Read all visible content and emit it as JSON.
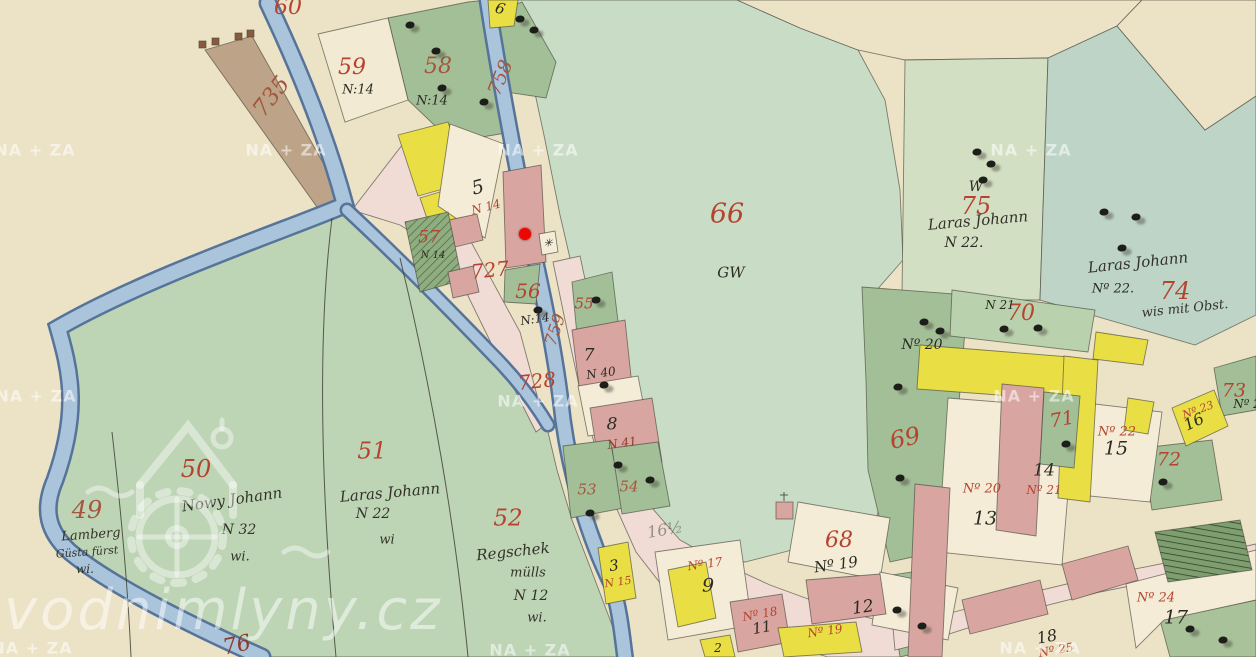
{
  "map": {
    "description": "Historical hand-drawn cadastral map sheet (watercolour parcels, stream, village) shown in vodnimlyny.cz map viewer",
    "marker": {
      "x": 525,
      "y": 234,
      "color": "#ee0600",
      "name": "mill-marker"
    },
    "watermarks": {
      "archive": {
        "text": "NA + ZA",
        "color": "#ffffff",
        "positions": [
          [
            35,
            150
          ],
          [
            286,
            150
          ],
          [
            538,
            150
          ],
          [
            1031,
            150
          ],
          [
            36,
            396
          ],
          [
            538,
            401
          ],
          [
            1034,
            396
          ],
          [
            32,
            648
          ],
          [
            530,
            650
          ],
          [
            1040,
            648
          ]
        ]
      },
      "site": {
        "text": "vodnimlyny.cz",
        "color": "#ffffff"
      }
    },
    "labels": [
      {
        "t": "60",
        "x": 288,
        "y": 8,
        "s": 22,
        "c": "red"
      },
      {
        "t": "735",
        "x": 272,
        "y": 97,
        "s": 23,
        "r": -52,
        "c": "brownred"
      },
      {
        "t": "59",
        "x": 352,
        "y": 68,
        "s": 22,
        "c": "red"
      },
      {
        "t": "58",
        "x": 438,
        "y": 67,
        "s": 22,
        "c": "brownred"
      },
      {
        "t": "758",
        "x": 501,
        "y": 78,
        "s": 19,
        "r": -68,
        "c": "brownred"
      },
      {
        "t": "66",
        "x": 727,
        "y": 214,
        "s": 27,
        "c": "red"
      },
      {
        "t": "75",
        "x": 976,
        "y": 206,
        "s": 24,
        "c": "red"
      },
      {
        "t": "74",
        "x": 1175,
        "y": 291,
        "s": 24,
        "c": "red"
      },
      {
        "t": "727",
        "x": 490,
        "y": 270,
        "s": 20,
        "r": -6,
        "c": "red"
      },
      {
        "t": "56",
        "x": 528,
        "y": 291,
        "s": 20,
        "c": "red"
      },
      {
        "t": "57",
        "x": 429,
        "y": 238,
        "s": 17,
        "c": "red"
      },
      {
        "t": "55",
        "x": 584,
        "y": 304,
        "s": 15,
        "c": "red"
      },
      {
        "t": "759",
        "x": 556,
        "y": 330,
        "s": 17,
        "r": -72,
        "c": "brownred"
      },
      {
        "t": "728",
        "x": 537,
        "y": 381,
        "s": 20,
        "r": -6,
        "c": "red"
      },
      {
        "t": "49",
        "x": 87,
        "y": 510,
        "s": 24,
        "c": "brownred"
      },
      {
        "t": "50",
        "x": 196,
        "y": 469,
        "s": 24,
        "c": "red"
      },
      {
        "t": "51",
        "x": 372,
        "y": 452,
        "s": 23,
        "c": "red"
      },
      {
        "t": "52",
        "x": 508,
        "y": 519,
        "s": 23,
        "c": "red"
      },
      {
        "t": "53",
        "x": 587,
        "y": 490,
        "s": 15,
        "c": "brownred"
      },
      {
        "t": "54",
        "x": 629,
        "y": 487,
        "s": 15,
        "c": "brownred"
      },
      {
        "t": "68",
        "x": 839,
        "y": 541,
        "s": 22,
        "c": "red"
      },
      {
        "t": "69",
        "x": 905,
        "y": 438,
        "s": 24,
        "r": -12,
        "c": "red"
      },
      {
        "t": "70",
        "x": 1021,
        "y": 314,
        "s": 22,
        "c": "red"
      },
      {
        "t": "71",
        "x": 1062,
        "y": 420,
        "s": 19,
        "r": -10,
        "c": "red"
      },
      {
        "t": "72",
        "x": 1169,
        "y": 460,
        "s": 19,
        "c": "red"
      },
      {
        "t": "73",
        "x": 1234,
        "y": 391,
        "s": 19,
        "c": "red"
      },
      {
        "t": "76",
        "x": 237,
        "y": 646,
        "s": 22,
        "r": -12,
        "c": "darkred"
      },
      {
        "t": "N 14",
        "x": 486,
        "y": 207,
        "s": 12,
        "r": -14,
        "c": "red"
      },
      {
        "t": "Nº 17",
        "x": 705,
        "y": 564,
        "s": 12,
        "r": -8,
        "c": "red"
      },
      {
        "t": "N 15",
        "x": 618,
        "y": 582,
        "s": 11,
        "r": -8,
        "c": "red"
      },
      {
        "t": "Nº 18",
        "x": 760,
        "y": 614,
        "s": 12,
        "r": -10,
        "c": "red"
      },
      {
        "t": "Nº 19",
        "x": 825,
        "y": 631,
        "s": 12,
        "r": -8,
        "c": "red"
      },
      {
        "t": "Nº 20",
        "x": 982,
        "y": 489,
        "s": 13,
        "c": "red"
      },
      {
        "t": "Nº 21",
        "x": 1044,
        "y": 490,
        "s": 12,
        "c": "red"
      },
      {
        "t": "Nº 22",
        "x": 1117,
        "y": 432,
        "s": 13,
        "c": "red"
      },
      {
        "t": "Nº 23",
        "x": 1198,
        "y": 410,
        "s": 11,
        "r": -20,
        "c": "red"
      },
      {
        "t": "Nº 24",
        "x": 1156,
        "y": 598,
        "s": 13,
        "c": "red"
      },
      {
        "t": "Nº 25",
        "x": 1056,
        "y": 650,
        "s": 12,
        "r": -10,
        "c": "red"
      },
      {
        "t": "N 41",
        "x": 622,
        "y": 443,
        "s": 12,
        "r": -8,
        "c": "darkred"
      },
      {
        "t": "6",
        "x": 500,
        "y": 9,
        "s": 15,
        "r": 15,
        "c": "black"
      },
      {
        "t": "N:14",
        "x": 358,
        "y": 90,
        "s": 13,
        "c": "black"
      },
      {
        "t": "N:14",
        "x": 432,
        "y": 101,
        "s": 13,
        "c": "black"
      },
      {
        "t": "5",
        "x": 478,
        "y": 188,
        "s": 19,
        "r": -14,
        "c": "black"
      },
      {
        "t": "N:14",
        "x": 535,
        "y": 319,
        "s": 12,
        "r": -8,
        "c": "black"
      },
      {
        "t": "N 14",
        "x": 433,
        "y": 256,
        "s": 10,
        "c": "black"
      },
      {
        "t": "GW",
        "x": 731,
        "y": 273,
        "s": 15,
        "c": "black"
      },
      {
        "t": "W",
        "x": 976,
        "y": 187,
        "s": 14,
        "c": "black"
      },
      {
        "t": "N 22.",
        "x": 964,
        "y": 243,
        "s": 14,
        "c": "black"
      },
      {
        "t": "Nº 22.",
        "x": 1113,
        "y": 289,
        "s": 13,
        "c": "black"
      },
      {
        "t": "Nº 20",
        "x": 922,
        "y": 345,
        "s": 14,
        "c": "black"
      },
      {
        "t": "N 21",
        "x": 1000,
        "y": 305,
        "s": 12,
        "c": "black"
      },
      {
        "t": "N 40",
        "x": 601,
        "y": 373,
        "s": 12,
        "r": -8,
        "c": "black"
      },
      {
        "t": "7",
        "x": 589,
        "y": 356,
        "s": 17,
        "c": "black"
      },
      {
        "t": "8",
        "x": 612,
        "y": 425,
        "s": 17,
        "c": "black"
      },
      {
        "t": "3",
        "x": 614,
        "y": 566,
        "s": 15,
        "r": -8,
        "c": "black"
      },
      {
        "t": "9",
        "x": 708,
        "y": 586,
        "s": 19,
        "c": "black"
      },
      {
        "t": "11",
        "x": 762,
        "y": 628,
        "s": 15,
        "r": -10,
        "c": "black"
      },
      {
        "t": "12",
        "x": 863,
        "y": 608,
        "s": 17,
        "r": -8,
        "c": "black"
      },
      {
        "t": "13",
        "x": 985,
        "y": 519,
        "s": 19,
        "c": "black"
      },
      {
        "t": "14",
        "x": 1044,
        "y": 471,
        "s": 17,
        "c": "black"
      },
      {
        "t": "15",
        "x": 1116,
        "y": 449,
        "s": 19,
        "c": "black"
      },
      {
        "t": "16",
        "x": 1194,
        "y": 422,
        "s": 16,
        "r": -25,
        "c": "black"
      },
      {
        "t": "17",
        "x": 1176,
        "y": 618,
        "s": 19,
        "c": "black"
      },
      {
        "t": "18",
        "x": 1047,
        "y": 637,
        "s": 16,
        "r": -10,
        "c": "black"
      },
      {
        "t": "2",
        "x": 718,
        "y": 648,
        "s": 12,
        "c": "black"
      },
      {
        "t": "Nº 19",
        "x": 836,
        "y": 565,
        "s": 15,
        "r": -8,
        "c": "black"
      },
      {
        "t": "Nº 2",
        "x": 1247,
        "y": 404,
        "s": 12,
        "c": "black"
      },
      {
        "t": "✳",
        "x": 548,
        "y": 243,
        "s": 11,
        "c": "black",
        "n": "mill-wheel-symbol"
      },
      {
        "t": "Laras Johann",
        "x": 978,
        "y": 221,
        "s": 15,
        "r": -5,
        "c": "script"
      },
      {
        "t": "Laras Johann",
        "x": 1138,
        "y": 263,
        "s": 15,
        "r": -6,
        "c": "script"
      },
      {
        "t": "wis mit Obst.",
        "x": 1185,
        "y": 309,
        "s": 13,
        "r": -6,
        "c": "script"
      },
      {
        "t": "Nowy Johann",
        "x": 232,
        "y": 500,
        "s": 15,
        "r": -8,
        "c": "script"
      },
      {
        "t": "N 32",
        "x": 239,
        "y": 530,
        "s": 14,
        "c": "script"
      },
      {
        "t": "wi.",
        "x": 240,
        "y": 557,
        "s": 13,
        "c": "script"
      },
      {
        "t": "Lamberg",
        "x": 91,
        "y": 535,
        "s": 13,
        "r": -4,
        "c": "script"
      },
      {
        "t": "Güsta fürst",
        "x": 87,
        "y": 552,
        "s": 11,
        "r": -4,
        "c": "script"
      },
      {
        "t": "wi.",
        "x": 85,
        "y": 569,
        "s": 12,
        "c": "script"
      },
      {
        "t": "Laras Johann",
        "x": 390,
        "y": 493,
        "s": 15,
        "r": -5,
        "c": "script"
      },
      {
        "t": "N 22",
        "x": 373,
        "y": 514,
        "s": 14,
        "c": "script"
      },
      {
        "t": "wi",
        "x": 387,
        "y": 540,
        "s": 13,
        "c": "script"
      },
      {
        "t": "Regschek",
        "x": 513,
        "y": 552,
        "s": 15,
        "r": -6,
        "c": "script"
      },
      {
        "t": "mülls",
        "x": 528,
        "y": 573,
        "s": 13,
        "c": "script"
      },
      {
        "t": "N 12",
        "x": 531,
        "y": 596,
        "s": 14,
        "c": "script"
      },
      {
        "t": "wi.",
        "x": 537,
        "y": 618,
        "s": 13,
        "c": "script"
      },
      {
        "t": "16½",
        "x": 665,
        "y": 530,
        "s": 16,
        "r": -10,
        "c": "faded"
      }
    ],
    "trees": [
      [
        410,
        25
      ],
      [
        436,
        51
      ],
      [
        520,
        19
      ],
      [
        534,
        30
      ],
      [
        442,
        88
      ],
      [
        484,
        102
      ],
      [
        538,
        310
      ],
      [
        596,
        300
      ],
      [
        604,
        385
      ],
      [
        590,
        513
      ],
      [
        618,
        465
      ],
      [
        650,
        480
      ],
      [
        977,
        152
      ],
      [
        991,
        164
      ],
      [
        983,
        180
      ],
      [
        1104,
        212
      ],
      [
        1136,
        217
      ],
      [
        1122,
        248
      ],
      [
        924,
        322
      ],
      [
        940,
        331
      ],
      [
        898,
        387
      ],
      [
        900,
        478
      ],
      [
        897,
        610
      ],
      [
        922,
        626
      ],
      [
        1004,
        329
      ],
      [
        1038,
        328
      ],
      [
        1066,
        444
      ],
      [
        1163,
        482
      ],
      [
        1190,
        629
      ],
      [
        1223,
        640
      ]
    ]
  }
}
